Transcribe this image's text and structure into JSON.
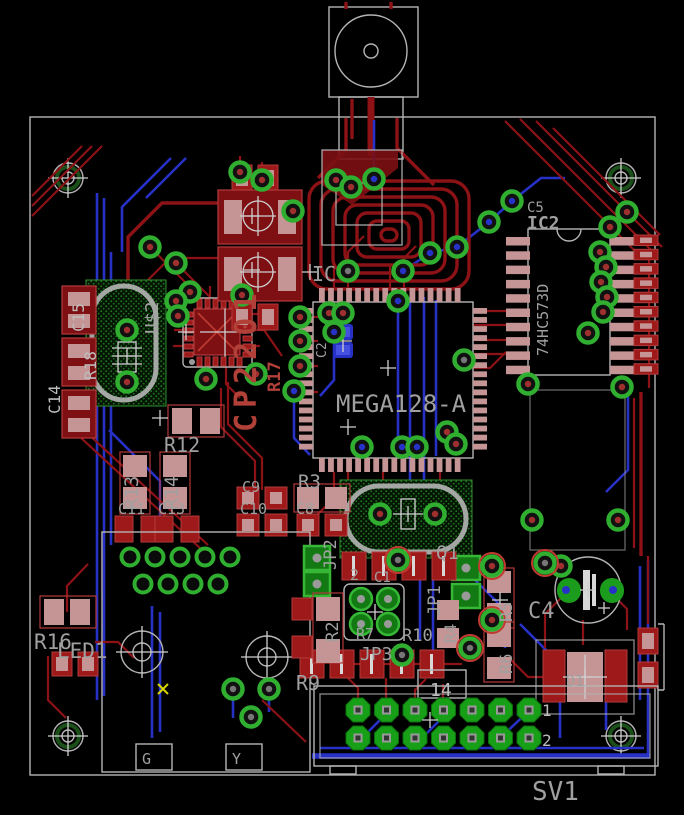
{
  "view": {
    "type": "pcb-board-layout"
  },
  "colors": {
    "background": "#000000",
    "top_copper": "#8c1216",
    "bottom_copper": "#2731c6",
    "smd_pad": "#c59595",
    "red_pad": "#9e1a1a",
    "via_ring": "#2fae2f",
    "silkscreen": "#b5b5b5",
    "label_gray": "#a0a0a0",
    "label_red": "#b04038",
    "hatch_green": "#1e8a1e"
  },
  "labels": {
    "mega": "MEGA128-A",
    "ic_ref": "IC",
    "c2": "C2",
    "c5": "C5",
    "ic2": "IC2",
    "hc573": "74HC573D",
    "cp2201": "CP2201",
    "r17": "R17",
    "u2": "U$2",
    "c15": "C15",
    "r18": "R18",
    "c14": "C14",
    "r12": "R12",
    "r13": "R13",
    "r14": "R14",
    "c11": "C11",
    "c13": "C13",
    "c9": "C9",
    "c10": "C10",
    "r3": "R3",
    "c8": "C8",
    "jp2": "JP2",
    "jp2_pin2": "2",
    "c1": "C1",
    "q1": "Q1",
    "jp1": "JP1",
    "r4": "R4",
    "r2": "R2",
    "r7": "R7",
    "r10": "R10",
    "jp3": "JP3",
    "r9": "R9",
    "pin14": "14",
    "pin1": "1",
    "pin2": "2",
    "sv1": "SV1",
    "r16": "R16",
    "led1": "LED1",
    "r5": "R5",
    "c4": "C4",
    "r6": "R6",
    "d1": "D1",
    "g": "G",
    "y": "Y"
  },
  "board": {
    "vias": [
      [
        240,
        172,
        "r"
      ],
      [
        262,
        180,
        "r"
      ],
      [
        293,
        211,
        "r"
      ],
      [
        336,
        180,
        "r"
      ],
      [
        351,
        187,
        "r"
      ],
      [
        374,
        179,
        "b"
      ],
      [
        403,
        271,
        "b"
      ],
      [
        430,
        253,
        "b"
      ],
      [
        457,
        247,
        "b"
      ],
      [
        489,
        222,
        "b"
      ],
      [
        512,
        201,
        "b"
      ],
      [
        190,
        292,
        "r"
      ],
      [
        176,
        301,
        "r"
      ],
      [
        178,
        316,
        "r"
      ],
      [
        242,
        295,
        "r"
      ],
      [
        256,
        374,
        "r"
      ],
      [
        206,
        379,
        "r"
      ],
      [
        150,
        247,
        "r"
      ],
      [
        176,
        263,
        "r"
      ],
      [
        300,
        317,
        "r"
      ],
      [
        300,
        341,
        "r"
      ],
      [
        300,
        366,
        "r"
      ],
      [
        294,
        391,
        "b"
      ],
      [
        329,
        313,
        "r"
      ],
      [
        343,
        313,
        "r"
      ],
      [
        334,
        332,
        "b"
      ],
      [
        398,
        301,
        "b"
      ],
      [
        348,
        271,
        "n"
      ],
      [
        362,
        447,
        "b"
      ],
      [
        402,
        447,
        "b"
      ],
      [
        417,
        447,
        "b"
      ],
      [
        447,
        432,
        "r"
      ],
      [
        456,
        444,
        "r"
      ],
      [
        464,
        360,
        "n"
      ],
      [
        528,
        384,
        "r"
      ],
      [
        588,
        333,
        "r"
      ],
      [
        622,
        387,
        "r"
      ],
      [
        600,
        252,
        "r"
      ],
      [
        606,
        267,
        "r"
      ],
      [
        601,
        282,
        "r"
      ],
      [
        607,
        297,
        "r"
      ],
      [
        603,
        312,
        "r"
      ],
      [
        610,
        227,
        "r"
      ],
      [
        627,
        212,
        "r"
      ],
      [
        127,
        330,
        "r"
      ],
      [
        127,
        382,
        "r"
      ],
      [
        380,
        514,
        "r"
      ],
      [
        435,
        514,
        "r"
      ],
      [
        532,
        520,
        "r"
      ],
      [
        618,
        520,
        "r"
      ],
      [
        233,
        689,
        "n"
      ],
      [
        269,
        689,
        "n"
      ],
      [
        251,
        717,
        "n"
      ],
      [
        561,
        566,
        "r"
      ],
      [
        398,
        560,
        "n"
      ],
      [
        470,
        648,
        "n"
      ],
      [
        545,
        563,
        "n"
      ],
      [
        492,
        566,
        "r"
      ],
      [
        492,
        620,
        "r"
      ],
      [
        402,
        655,
        "n"
      ]
    ],
    "circled_vias": [
      [
        398,
        560
      ],
      [
        470,
        648
      ],
      [
        545,
        563
      ],
      [
        492,
        566
      ],
      [
        492,
        620
      ]
    ],
    "sv1_pin_count": 14,
    "jp3_pin_count": 4
  }
}
